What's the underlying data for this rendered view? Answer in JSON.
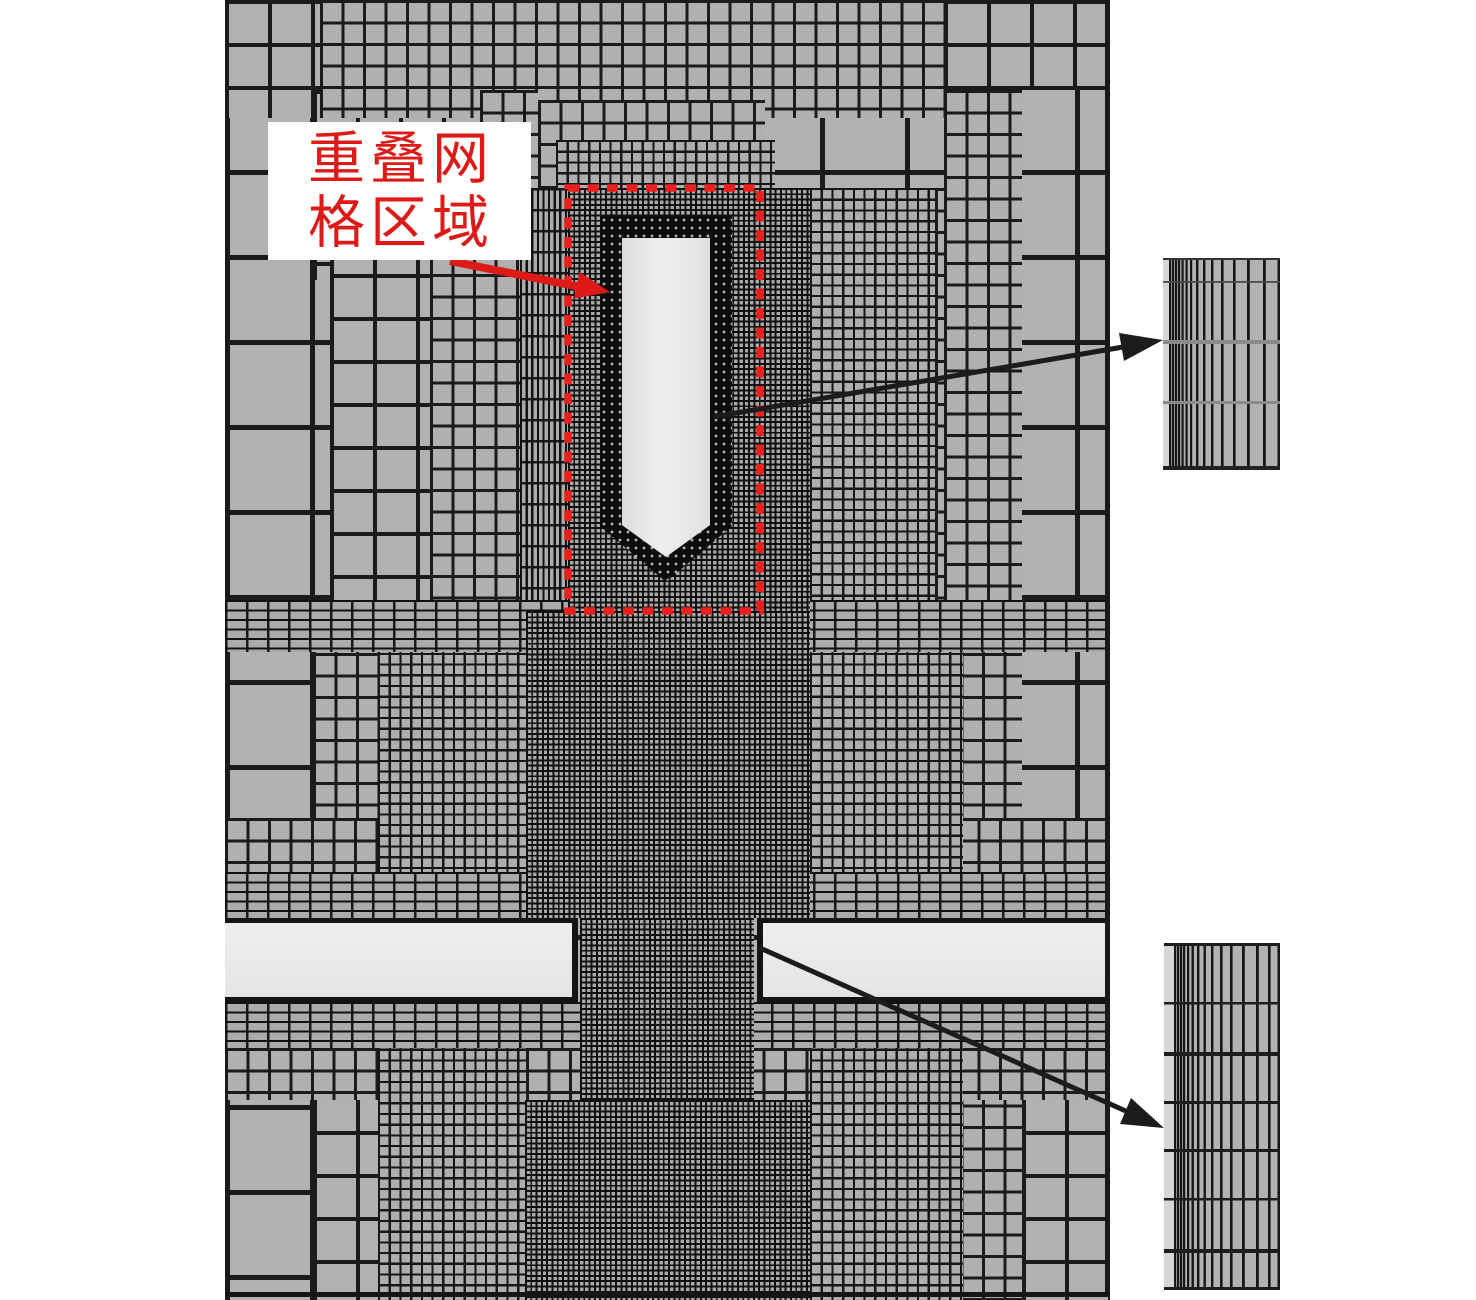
{
  "figure": {
    "kind": "CFD overset-mesh refinement figure",
    "annotation": {
      "label_full": "重叠网格区域",
      "label_line1": "重叠网",
      "label_line2": "格区域"
    },
    "colors": {
      "annotation_red": "#dc1a17",
      "overset_outline_red": "#e8201e",
      "mesh_cell_gray": "#b2b2b2",
      "mesh_line_dark": "#1b1b1b",
      "body_fill": "#e6e6e6",
      "plate_fill": "#e8e8e8",
      "page_background": "#ffffff"
    }
  }
}
